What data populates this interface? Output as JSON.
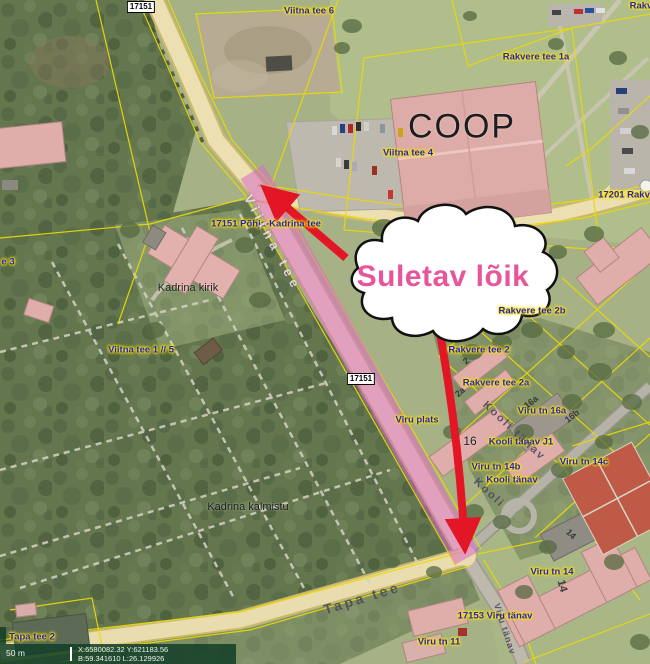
{
  "map": {
    "annotation": {
      "text": "Suletav lõik"
    },
    "scalebar": {
      "scale_text": "50 m",
      "coord_line1": "X:6580082.32 Y:621183.56",
      "coord_line2": "B:59.341610 L:26.129926"
    },
    "colors": {
      "highlight-pink": "#d96cc9",
      "arrow-red": "#e31626",
      "cloud-text-pink": "#e7559b",
      "street-label-blue": "#2222cd",
      "cadastral-yellow": "#e8d80a"
    },
    "labels": [
      {
        "name": "road-number-17151-top",
        "text": "17151",
        "x": 141,
        "y": 7,
        "cls": "rn"
      },
      {
        "name": "label-viitna-tee-6",
        "text": "Viitna tee 6",
        "x": 309,
        "y": 11,
        "cls": "st"
      },
      {
        "name": "label-rakvere-top-right",
        "text": "Rakvere t",
        "x": 651,
        "y": 6,
        "cls": "st"
      },
      {
        "name": "label-rakvere-tee-1a",
        "text": "Rakvere tee 1a",
        "x": 536,
        "y": 57,
        "cls": "st"
      },
      {
        "name": "label-coop",
        "text": "COOP",
        "x": 462,
        "y": 127,
        "cls": "pl",
        "size": 34,
        "ls": 2
      },
      {
        "name": "label-viitna-tee-4",
        "text": "Viitna tee 4",
        "x": 408,
        "y": 153,
        "cls": "st"
      },
      {
        "name": "label-17201-rakvere",
        "text": "17201 Rakv",
        "x": 624,
        "y": 195,
        "cls": "st"
      },
      {
        "name": "label-pohja-kadrina-tee",
        "text": "17151 Põhja-Kadrina tee",
        "x": 266,
        "y": 224,
        "cls": "st"
      },
      {
        "name": "road-name-viitna-tee",
        "text": "Viitna tee",
        "x": 273,
        "y": 243,
        "cls": "rl",
        "rot": 62
      },
      {
        "name": "label-tee-3-clipped",
        "text": "e 3",
        "x": 8,
        "y": 262,
        "cls": "st"
      },
      {
        "name": "label-kadrina-kirik",
        "text": "Kadrina kirik",
        "x": 188,
        "y": 288,
        "cls": "pl"
      },
      {
        "name": "label-rakvere-tee-2b",
        "text": "Rakvere tee 2b",
        "x": 532,
        "y": 311,
        "cls": "st"
      },
      {
        "name": "label-viitna-tee-1-5",
        "text": "Viitna tee 1 // 5",
        "x": 141,
        "y": 350,
        "cls": "st"
      },
      {
        "name": "label-rakvere-tee-2",
        "text": "Rakvere tee 2",
        "x": 479,
        "y": 350,
        "cls": "st"
      },
      {
        "name": "building-number-2",
        "text": "2",
        "x": 466,
        "y": 361,
        "cls": "bn",
        "rot": -40
      },
      {
        "name": "label-rakvere-tee-2a",
        "text": "Rakvere tee 2a",
        "x": 496,
        "y": 383,
        "cls": "st"
      },
      {
        "name": "road-number-17151-mid",
        "text": "17151",
        "x": 361,
        "y": 379,
        "cls": "rn"
      },
      {
        "name": "building-number-2a",
        "text": "2a",
        "x": 460,
        "y": 392,
        "cls": "bn",
        "rot": -40
      },
      {
        "name": "label-viru-tn-16a",
        "text": "Viru tn 16a",
        "x": 542,
        "y": 411,
        "cls": "st"
      },
      {
        "name": "building-number-16a",
        "text": "16a",
        "x": 531,
        "y": 402,
        "cls": "bn",
        "rot": -38
      },
      {
        "name": "building-number-16b",
        "text": "16b",
        "x": 572,
        "y": 416,
        "cls": "bn",
        "rot": -38
      },
      {
        "name": "label-viru-plats",
        "text": "Viru plats",
        "x": 417,
        "y": 420,
        "cls": "st"
      },
      {
        "name": "label-kooli-tanav-j1",
        "text": "Kooli tänav J1",
        "x": 521,
        "y": 442,
        "cls": "st"
      },
      {
        "name": "road-name-kooli-tanav",
        "text": "Kooli tänav",
        "x": 514,
        "y": 431,
        "cls": "rt",
        "rot": 43
      },
      {
        "name": "building-number-16",
        "text": "16",
        "x": 470,
        "y": 441,
        "cls": "pl",
        "size": 12
      },
      {
        "name": "label-viru-tn-14b",
        "text": "Viru tn 14b",
        "x": 496,
        "y": 467,
        "cls": "st"
      },
      {
        "name": "label-kooli-tanav",
        "text": "Kooli tänav",
        "x": 512,
        "y": 480,
        "cls": "st"
      },
      {
        "name": "road-name-kooli-partial",
        "text": "Kooli",
        "x": 489,
        "y": 493,
        "cls": "rt",
        "rot": 43
      },
      {
        "name": "label-viru-tn-14c",
        "text": "Viru tn 14c",
        "x": 584,
        "y": 462,
        "cls": "st"
      },
      {
        "name": "label-kadrina-kalmistu",
        "text": "Kadrina kalmistu",
        "x": 248,
        "y": 507,
        "cls": "pl"
      },
      {
        "name": "building-number-14-gray",
        "text": "14",
        "x": 571,
        "y": 534,
        "cls": "bn",
        "rot": 45
      },
      {
        "name": "label-viru-tn-14",
        "text": "Viru tn 14",
        "x": 552,
        "y": 572,
        "cls": "st"
      },
      {
        "name": "building-number-14",
        "text": "14",
        "x": 562,
        "y": 586,
        "cls": "bn",
        "rot": 75,
        "size": 11
      },
      {
        "name": "road-name-tapa-tee",
        "text": "Tapa tee",
        "x": 362,
        "y": 598,
        "cls": "rt",
        "rot": -17,
        "size": 14,
        "ls": 3
      },
      {
        "name": "label-17153-viru-tanav",
        "text": "17153 Viru tänav",
        "x": 495,
        "y": 616,
        "cls": "st"
      },
      {
        "name": "road-name-viru-tanav",
        "text": "Viru tänav",
        "x": 505,
        "y": 629,
        "cls": "rt",
        "rot": 72,
        "size": 9,
        "ls": 1
      },
      {
        "name": "label-viru-tn-11",
        "text": "Viru tn 11",
        "x": 439,
        "y": 642,
        "cls": "st"
      },
      {
        "name": "label-tapa-tee-2",
        "text": "Tapa tee 2",
        "x": 32,
        "y": 637,
        "cls": "st"
      }
    ]
  }
}
